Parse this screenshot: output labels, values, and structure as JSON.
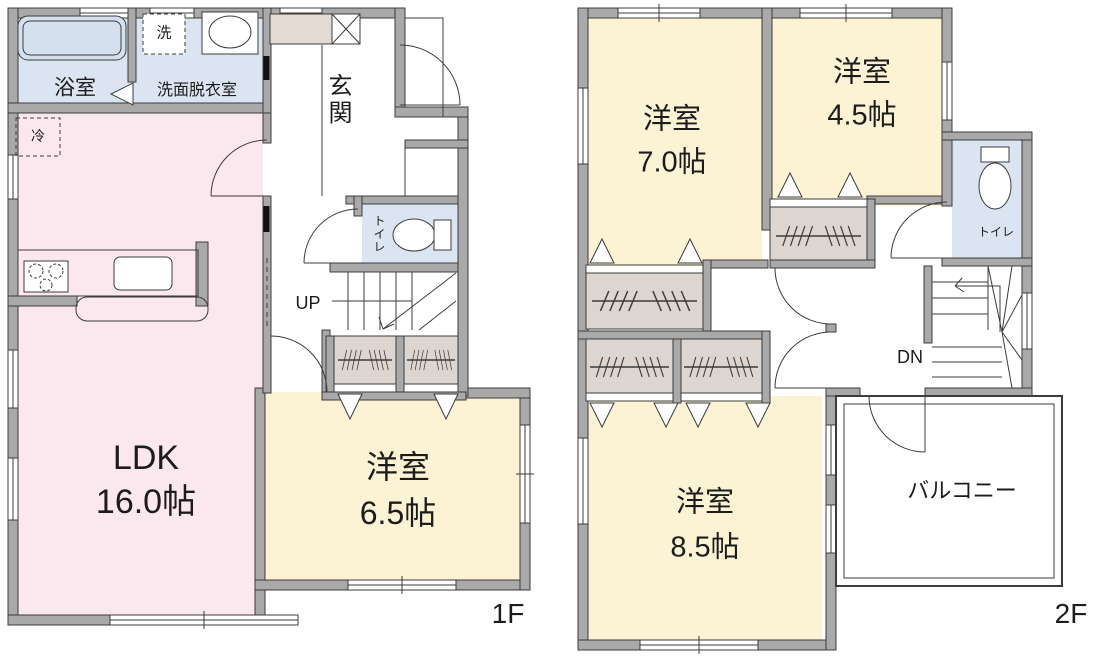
{
  "floor1": {
    "label": "1F",
    "rooms": {
      "ldk": {
        "name": "LDK",
        "size": "16.0帖"
      },
      "bath": {
        "name": "浴室"
      },
      "washroom": {
        "name": "洗面脱衣室"
      },
      "washer": {
        "label": "洗"
      },
      "fridge": {
        "label": "冷"
      },
      "entrance": {
        "name": "玄関"
      },
      "toilet": {
        "name": "トイレ"
      },
      "bedroom65": {
        "name": "洋室",
        "size": "6.5帖"
      },
      "stairs": {
        "label": "UP"
      }
    }
  },
  "floor2": {
    "label": "2F",
    "rooms": {
      "bedroom70": {
        "name": "洋室",
        "size": "7.0帖"
      },
      "bedroom45": {
        "name": "洋室",
        "size": "4.5帖"
      },
      "bedroom85": {
        "name": "洋室",
        "size": "8.5帖"
      },
      "toilet": {
        "name": "トイレ"
      },
      "balcony": {
        "name": "バルコニー"
      },
      "stairs": {
        "label": "DN"
      }
    }
  },
  "colors": {
    "wall": "#a9a9a9",
    "line": "#3c3c3c",
    "ldk": "#fbe7ee",
    "bedroom": "#fcf3d4",
    "wet": "#dbe5f2",
    "tub": "#d5e0ef",
    "closet": "#ddd5d0",
    "cabinet": "#e3dbd3",
    "white": "#ffffff"
  }
}
